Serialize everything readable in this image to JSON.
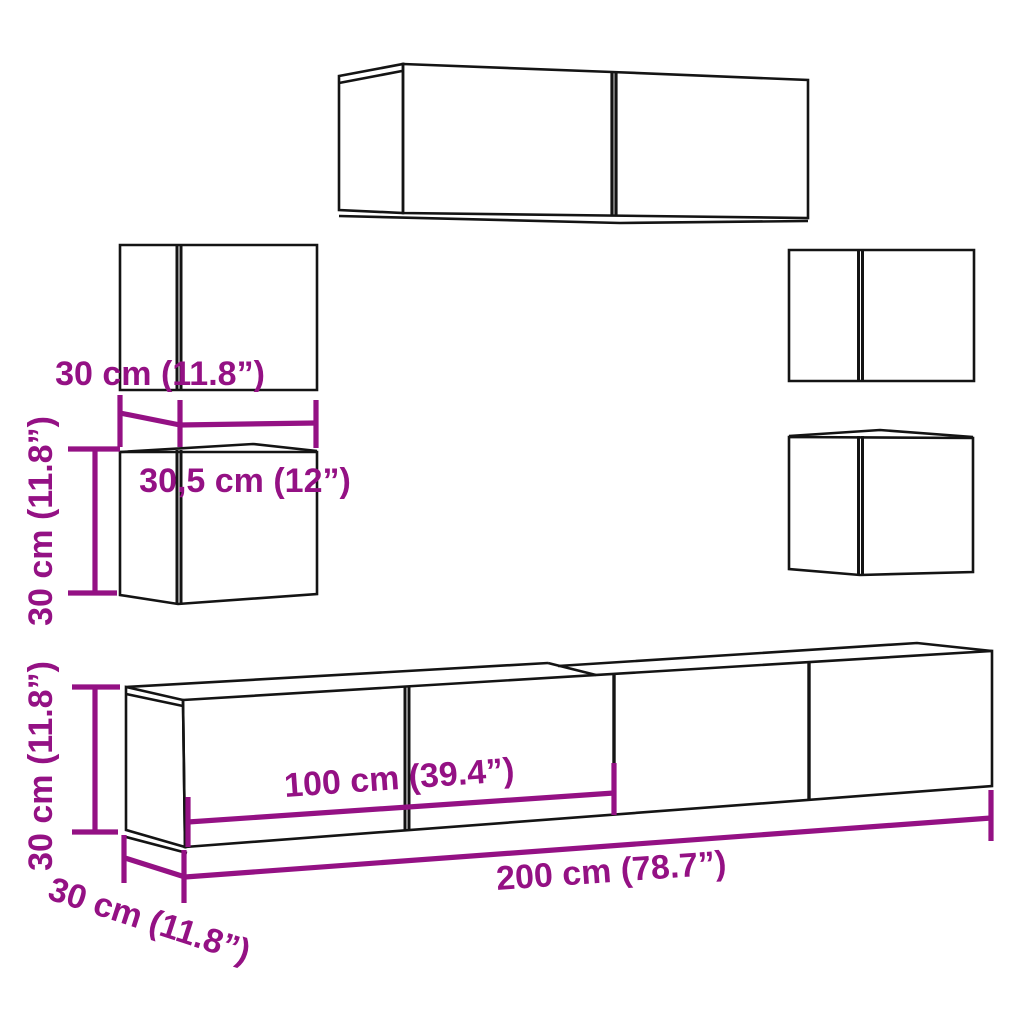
{
  "diagram": {
    "description": "Dimension diagram of a 7-piece wall-mounted TV cabinet set",
    "units": "cm / inches"
  },
  "colors": {
    "accent": "#941184",
    "line": "#141414",
    "background": "#ffffff"
  },
  "labels": {
    "cabinet_depth_top": "30 cm (11.8”)",
    "cabinet_width": "30,5 cm (12”)",
    "cabinet_height_left": "30 cm (11.8”)",
    "stand_height": "30 cm (11.8”)",
    "stand_half_width": "100 cm (39.4”)",
    "stand_full_width": "200 cm (78.7”)",
    "stand_depth": "30 cm (11.8”)"
  }
}
